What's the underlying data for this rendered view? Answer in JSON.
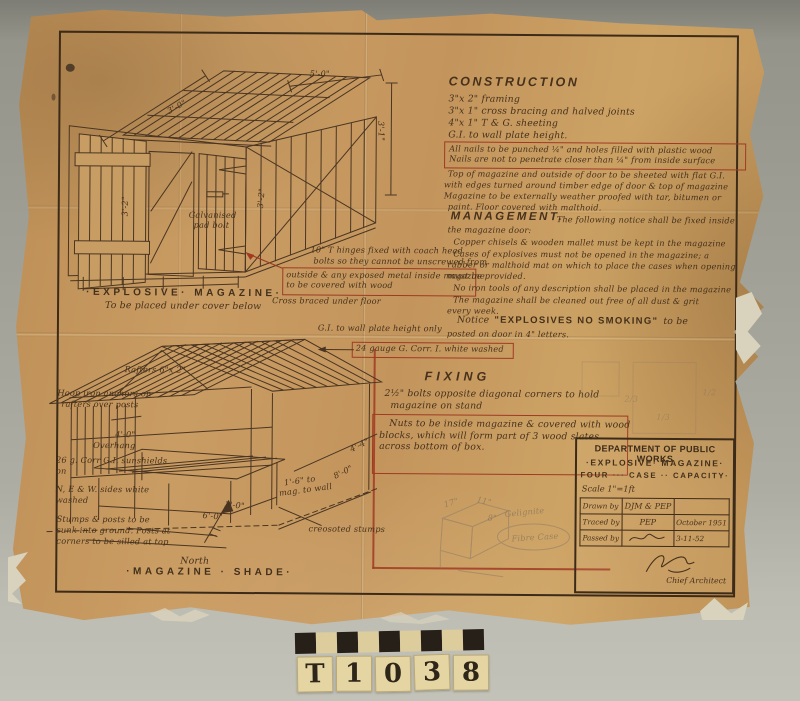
{
  "construction": {
    "heading": "CONSTRUCTION",
    "items": [
      "3\"x 2\" framing",
      "3\"x 1\" cross bracing and halved joints",
      "4\"x 1\" T & G. sheeting",
      "G.I. to wall plate height."
    ],
    "boxed_line1": "All nails to be punched ¼\" and holes filled with plastic wood",
    "boxed_line2": "Nails are not to penetrate closer than ¼\" from inside surface",
    "para1a": "Top of magazine and outside of door to be sheeted with flat G.I.",
    "para1b": "with edges turned around timber edge of door & top of magazine",
    "para2a": "Magazine to be externally weather proofed with tar, bitumen or",
    "para2b": "paint. Floor covered with malthoid."
  },
  "management": {
    "heading": "MANAGEMENT.",
    "intro1": "The following notice shall be fixed inside",
    "intro2": "the magazine door:",
    "rule1": "Copper chisels & wooden mallet must be kept in the magazine",
    "rule2a": "Cases of explosives must not be opened in the magazine; a",
    "rule2b": "rubber or malthoid mat on which to place the cases when opening",
    "rule2c": "must be provided.",
    "rule3": "No iron tools of any description shall be placed in the magazine",
    "rule4a": "The magazine shall be cleaned out free of all dust & grit",
    "rule4b": "every week.",
    "notice_prefix": "Notice",
    "notice_caps": "\"EXPLOSIVES NO SMOKING\"",
    "notice_suffix": "to be",
    "notice_line2": "posted on door in 4\" letters."
  },
  "fixing": {
    "heading": "FIXING",
    "line1": "2½\" bolts opposite diagonal corners to hold",
    "line2": "magazine on stand",
    "boxed1": "Nuts to be inside magazine & covered with wood",
    "boxed2": "blocks, which will form part of 3 wood slates",
    "boxed3": "across bottom of box."
  },
  "magazine": {
    "title": "·EXPLOSIVE· MAGAZINE·",
    "subtitle": "To be placed under cover below",
    "pad_bolt1": "Galvanised",
    "pad_bolt2": "pad bolt",
    "hinge1": "10\" T hinges fixed with coach head",
    "hinge2": "bolts so they cannot be unscrewed from",
    "hinge_boxed1": "outside & any exposed metal inside magazine",
    "hinge_boxed2": "to be covered with wood",
    "cross_braced": "Cross braced under floor",
    "dim_top": "5'-0\"",
    "dim_slope": "3'-0\"",
    "dim_right": "3'-1\"",
    "dim_door": "3'-2\""
  },
  "shade": {
    "gi_note": "G.I. to wall plate height only",
    "corr_boxed": "24 gauge G. Corr. I. white washed",
    "rafters": "Rafters 6\"x 2\"",
    "hoop1": "Hoop iron anchors on",
    "hoop2": "rafters over posts",
    "overhang_dim": "4'-0\"",
    "overhang": "Overhang",
    "corr26a": "26 g. Corr G.I. sunshields",
    "corr26b": "on",
    "sides1": "N, E & W. sides white",
    "sides2": "washed",
    "stumps1": "Stumps & posts to be",
    "stumps2": "sunk into ground. Posts at",
    "stumps3": "corners to be silled at top",
    "creosoted": "creosoted stumps",
    "from_mag1": "1'-6\" to",
    "from_mag2": "mag. to wall",
    "dim_a": "3'-0\"",
    "dim_b": "6'-0\"",
    "dim_c": "8'-0\"",
    "dim_d": "4'-4\"",
    "north": "North",
    "title": "·MAGAZINE · SHADE·"
  },
  "title_block": {
    "dept": "DEPARTMENT OF PUBLIC WORKS",
    "line1": "·EXPLOSIVE· MAGAZINE·",
    "line2": "FOUR ··· CASE ·· CAPACITY·",
    "scale": "Scale 1\"=1ft",
    "rows": [
      {
        "label": "Drawn by",
        "value": "DJM & PEP",
        "date": ""
      },
      {
        "label": "Traced by",
        "value": "PEP",
        "date": "October 1951"
      },
      {
        "label": "Passed by",
        "value": "",
        "date": "3-11-52"
      }
    ],
    "chief": "Chief Architect"
  },
  "pencil": {
    "dim17": "17\"",
    "dim11": "11\"",
    "dim8": "8\"",
    "note1": "Gelignite",
    "note2": "Fibre Case",
    "f23": "2/3",
    "f13": "1/3",
    "f12": "1/2"
  },
  "photo_label": {
    "chars": [
      "T",
      "1",
      "0",
      "3",
      "8"
    ]
  },
  "colors": {
    "paper": "#c3955d",
    "ink": "#46311c",
    "red_ink": "#a03a22",
    "pencil": "#8d7c66",
    "background": "#a3a399"
  }
}
